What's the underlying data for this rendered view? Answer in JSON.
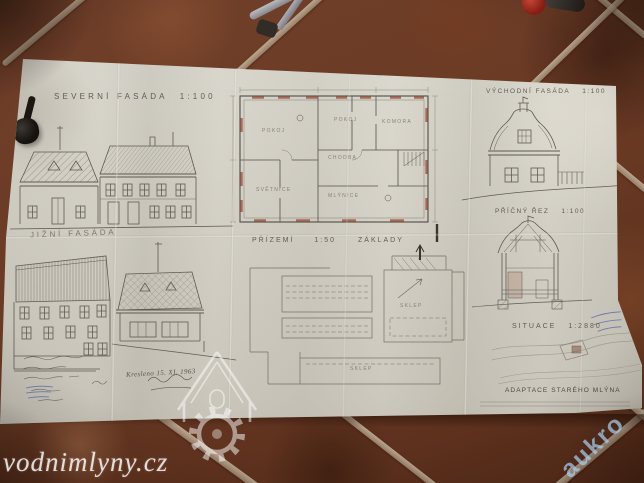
{
  "drawings": {
    "north_facade": {
      "label": "SEVERNÍ FASÁDA",
      "scale": "1:100"
    },
    "east_facade": {
      "label": "VÝCHODNÍ FASÁDA",
      "scale": "1:100"
    },
    "cross_section": {
      "label": "PŘÍČNÝ ŘEZ",
      "scale": "1:100"
    },
    "south_facade": {
      "label": "JIŽNÍ FASÁDA",
      "scale": ""
    },
    "ground_floor": {
      "label": "PŘÍZEMÍ",
      "scale": "1:50"
    },
    "foundations": {
      "label": "ZÁKLADY",
      "scale": ""
    },
    "site_plan": {
      "label": "SITUACE",
      "scale": "1:2880"
    },
    "rooms": [
      "POKOJ",
      "POKOJ",
      "KOMORA",
      "CHODBA",
      "SVĚTNICE",
      "MLÝNICE"
    ],
    "cellar_rooms": [
      "SKLEP",
      "SKLEP"
    ]
  },
  "title_block": {
    "project_title": "ADAPTACE STARÉHO MLÝNA"
  },
  "annotations": {
    "date_note": "Kresleno 15. XI. 1963"
  },
  "watermarks": {
    "site": "vodnimlyny.cz",
    "auction": "aukro"
  },
  "colors": {
    "tile": "#6e3c25",
    "grout": "#b29a80",
    "paper": "#d6d3c9",
    "ink": "#5b574e",
    "plan_accent": "#9b523f",
    "stamp_blue": "#4e62aa",
    "watermark_blue": "#a8cde7"
  }
}
